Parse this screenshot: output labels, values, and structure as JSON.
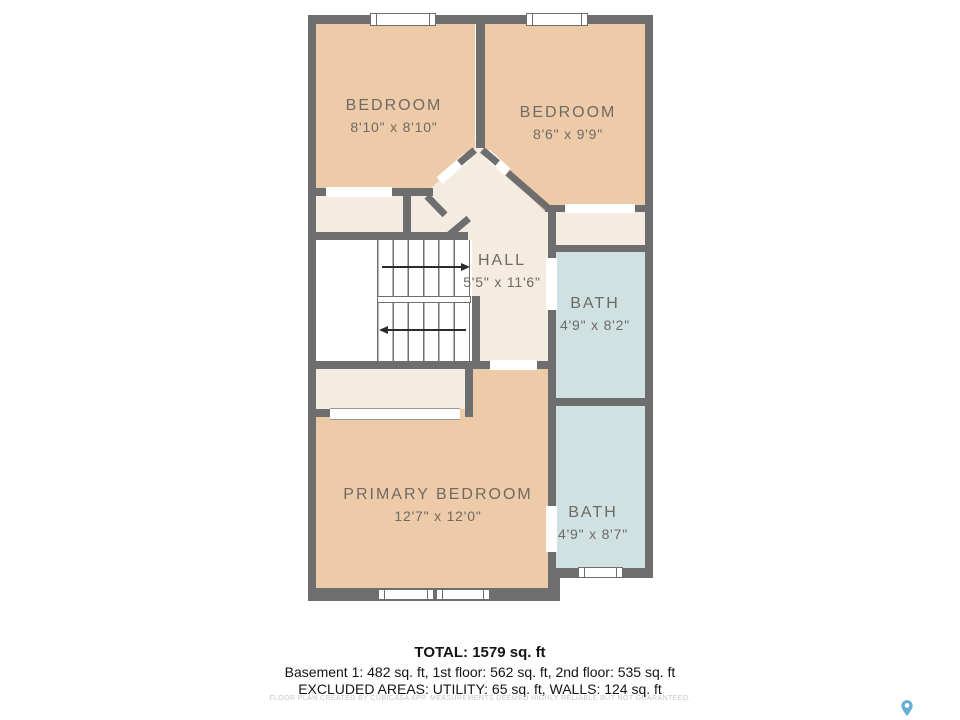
{
  "floorplan": {
    "rooms": [
      {
        "name": "BEDROOM",
        "dims": "8'10\" x 8'10\""
      },
      {
        "name": "BEDROOM",
        "dims": "8'6\" x 9'9\""
      },
      {
        "name": "HALL",
        "dims": "5'5\" x 11'6\""
      },
      {
        "name": "BATH",
        "dims": "4'9\" x 8'2\""
      },
      {
        "name": "PRIMARY BEDROOM",
        "dims": "12'7\" x 12'0\""
      },
      {
        "name": "BATH",
        "dims": "4'9\" x 8'7\""
      }
    ],
    "colors": {
      "wall": "#6e6e6e",
      "bedroom_floor": "#eecba8",
      "hall_floor": "#f4ece1",
      "bath_floor": "#cfe1e1",
      "label_text": "#6f6a63",
      "logo_pin": "#67aed6"
    }
  },
  "summary": {
    "total": "TOTAL: 1579 sq. ft",
    "floors": "Basement 1: 482 sq. ft, 1st floor: 562 sq. ft, 2nd floor: 535 sq. ft",
    "excluded": "EXCLUDED AREAS: UTILITY: 65 sq. ft, WALLS: 124 sq. ft"
  },
  "disclaimer": "FLOOR PLAN CREATED BY CUBICASA APP. MEASUREMENTS DEEMED HIGHLY RELIABLE BUT NOT GUARANTEED."
}
